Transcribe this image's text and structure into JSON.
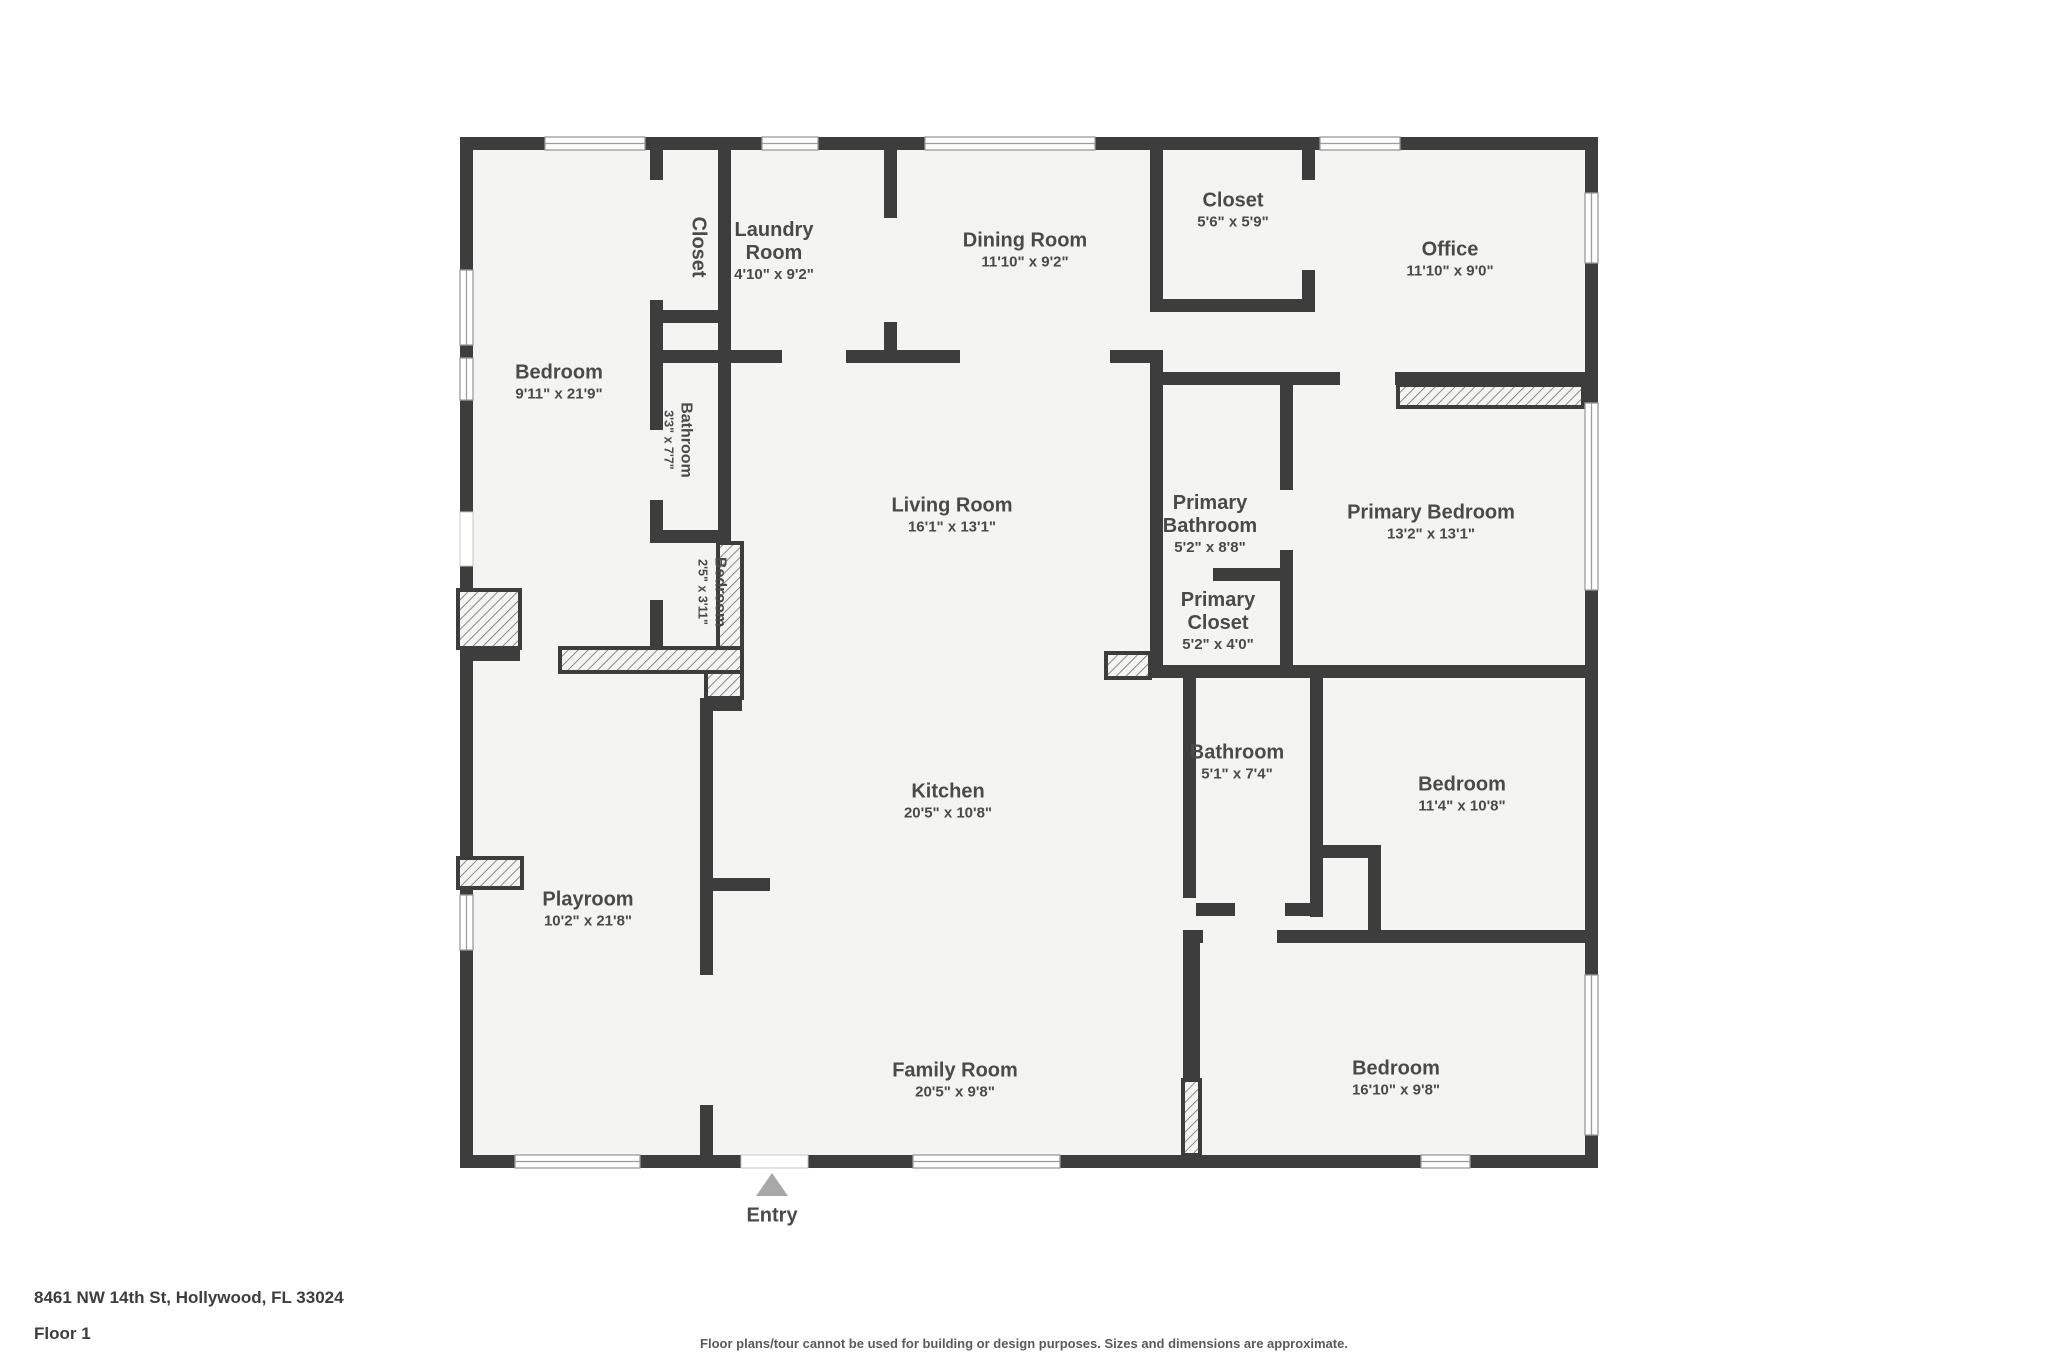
{
  "floorplan": {
    "address": "8461 NW 14th St, Hollywood, FL 33024",
    "floor_label": "Floor 1",
    "disclaimer": "Floor plans/tour cannot be used for building or design purposes. Sizes and dimensions are approximate.",
    "entry": {
      "label": "Entry",
      "marker": "triangle-up"
    },
    "colors": {
      "wall": "#3d3d3d",
      "floor": "#f4f4f2",
      "hatch_line": "#6f6f6f",
      "entry_marker": "#a8a8a8",
      "label_text": "#4a4a4a"
    },
    "rooms": [
      {
        "id": "bedroom-1",
        "name": "Bedroom",
        "dims": "9'11\" x 21'9\"",
        "x": 559,
        "y": 383
      },
      {
        "id": "closet-1",
        "name": "Closet",
        "dims": "",
        "x": 698,
        "y": 247,
        "vertical": true
      },
      {
        "id": "laundry-room",
        "name": "Laundry Room",
        "dims": "4'10\" x 9'2\"",
        "x": 774,
        "y": 252,
        "w": 110
      },
      {
        "id": "dining-room",
        "name": "Dining Room",
        "dims": "11'10\" x 9'2\"",
        "x": 1025,
        "y": 251
      },
      {
        "id": "closet-2",
        "name": "Closet",
        "dims": "5'6\" x 5'9\"",
        "x": 1233,
        "y": 211
      },
      {
        "id": "office",
        "name": "Office",
        "dims": "11'10\" x 9'0\"",
        "x": 1450,
        "y": 260
      },
      {
        "id": "bathroom-1",
        "name": "Bathroom",
        "dims": "3'3\" x 7'7\"",
        "x": 678,
        "y": 440,
        "vertical": true,
        "small": true
      },
      {
        "id": "living-room",
        "name": "Living Room",
        "dims": "16'1\" x 13'1\"",
        "x": 952,
        "y": 516
      },
      {
        "id": "primary-bathroom",
        "name": "Primary Bathroom",
        "dims": "5'2\" x 8'8\"",
        "x": 1210,
        "y": 525,
        "w": 140
      },
      {
        "id": "primary-bedroom",
        "name": "Primary Bedroom",
        "dims": "13'2\" x 13'1\"",
        "x": 1431,
        "y": 523
      },
      {
        "id": "bedroom-2",
        "name": "Bedroom",
        "dims": "2'5\" x 3'11\"",
        "x": 712,
        "y": 592,
        "vertical": true,
        "small": true
      },
      {
        "id": "primary-closet",
        "name": "Primary Closet",
        "dims": "5'2\" x 4'0\"",
        "x": 1218,
        "y": 622,
        "w": 120
      },
      {
        "id": "bathroom-2",
        "name": "Bathroom",
        "dims": "5'1\" x 7'4\"",
        "x": 1237,
        "y": 763
      },
      {
        "id": "bedroom-3",
        "name": "Bedroom",
        "dims": "11'4\" x 10'8\"",
        "x": 1462,
        "y": 795
      },
      {
        "id": "kitchen",
        "name": "Kitchen",
        "dims": "20'5\" x 10'8\"",
        "x": 948,
        "y": 802
      },
      {
        "id": "playroom",
        "name": "Playroom",
        "dims": "10'2\" x 21'8\"",
        "x": 588,
        "y": 910
      },
      {
        "id": "family-room",
        "name": "Family Room",
        "dims": "20'5\" x 9'8\"",
        "x": 955,
        "y": 1081
      },
      {
        "id": "bedroom-4",
        "name": "Bedroom",
        "dims": "16'10\" x 9'8\"",
        "x": 1396,
        "y": 1079
      }
    ]
  }
}
